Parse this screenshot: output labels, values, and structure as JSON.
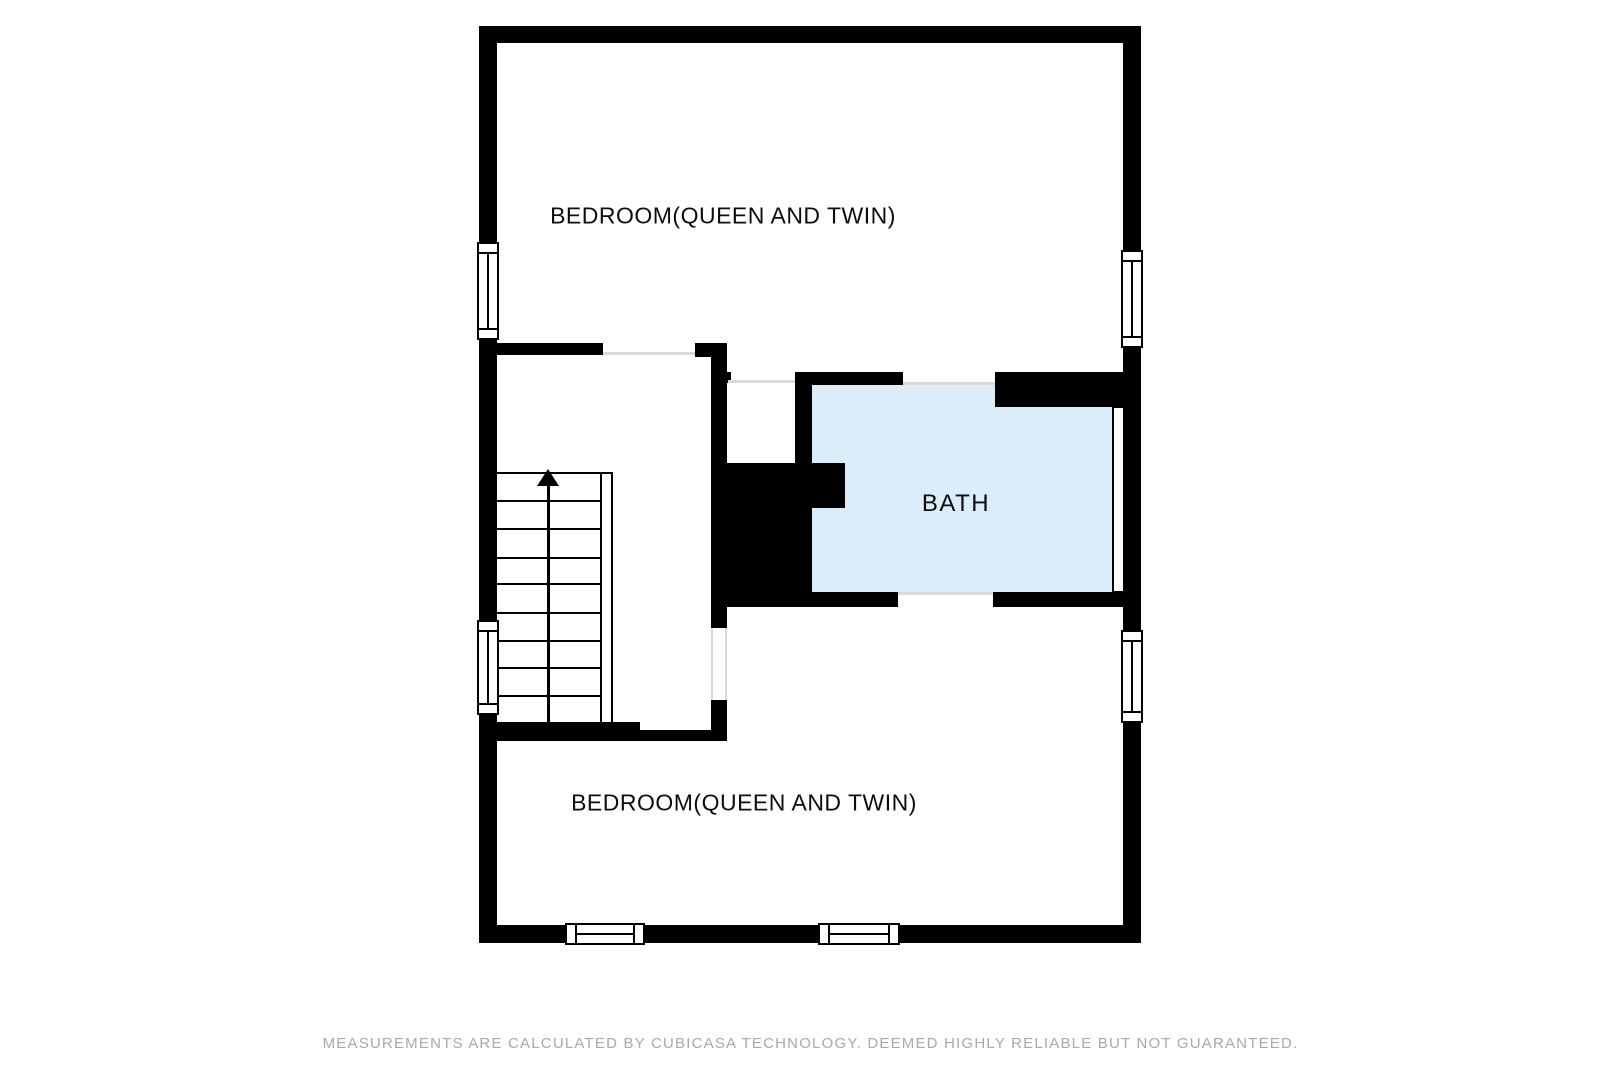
{
  "floor_plan": {
    "rooms": [
      {
        "id": "bedroom-top",
        "label": "BEDROOM(QUEEN AND TWIN)",
        "floor_color": "#ffffff"
      },
      {
        "id": "bath",
        "label": "BATH",
        "floor_color": "#dcedfa"
      },
      {
        "id": "bedroom-bottom",
        "label": "BEDROOM(QUEEN AND TWIN)",
        "floor_color": "#ffffff"
      }
    ],
    "stairs": {
      "direction_arrow": "up",
      "tread_count": 9
    },
    "wall_color": "#000000",
    "door_threshold_color": "#d9d9d9",
    "window_count": 6
  },
  "footer": {
    "disclaimer": "MEASUREMENTS ARE CALCULATED BY CUBICASA TECHNOLOGY. DEEMED HIGHLY RELIABLE BUT NOT GUARANTEED.",
    "text_color": "#a9a9a9"
  }
}
